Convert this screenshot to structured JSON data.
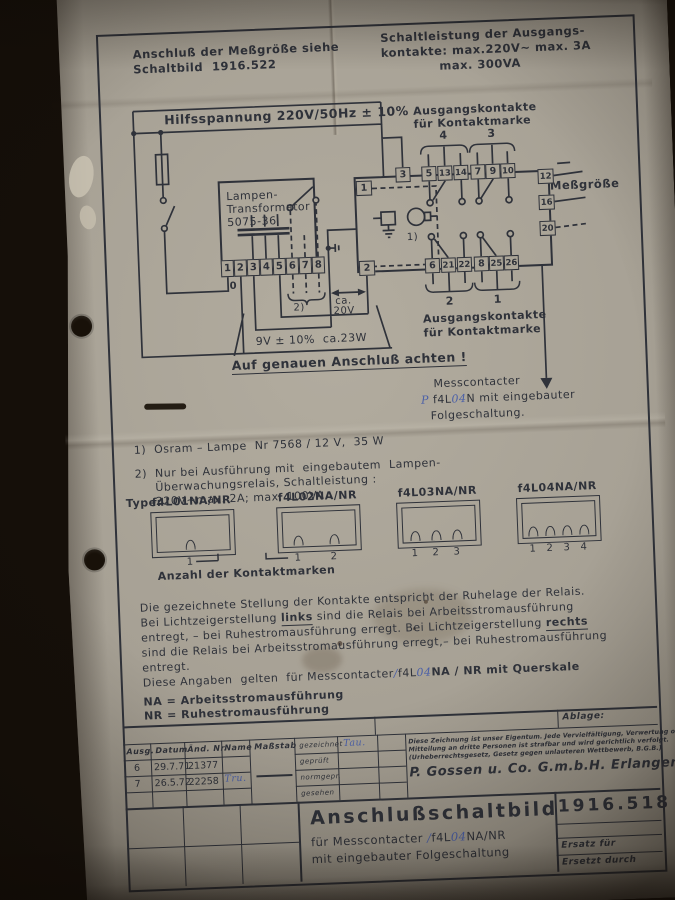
{
  "colors": {
    "paper": "#a9a397",
    "ink": "#2f323a",
    "hand_ink": "#4a5fa8"
  },
  "header": {
    "note_left_1": "Anschluß der Meßgröße siehe",
    "note_left_2": "Schaltbild  1916.522",
    "note_right_1": "Schaltleistung der Ausgangs-",
    "note_right_2": "kontakte: max.220V~ max. 3A",
    "note_right_3": "max. 300VA"
  },
  "schematic": {
    "bus_label": "Hilfsspannung 220V/50Hz ± 10%",
    "out_top": {
      "line1": "Ausgangskontakte",
      "line2": "für Kontaktmarke",
      "n_left": "4",
      "n_right": "3"
    },
    "out_bottom": {
      "n_left": "2",
      "n_right": "1",
      "line1": "Ausgangskontakte",
      "line2": "für Kontaktmarke"
    },
    "trafo": {
      "name1": "Lampen-",
      "name2": "Transformator",
      "name3": "5075-36",
      "terminals": [
        "1",
        "2",
        "3",
        "4",
        "5",
        "6",
        "7",
        "8"
      ],
      "zero": "0"
    },
    "relay": {
      "t1": "1",
      "t2": "2",
      "lamp_note": "1)",
      "top": [
        "3",
        "5",
        "13",
        "14",
        "7",
        "9",
        "10"
      ],
      "bottom": [
        "6",
        "21",
        "22",
        "8",
        "25",
        "26"
      ],
      "right": [
        "12",
        "16",
        "20"
      ]
    },
    "messgroesse": "Meßgröße",
    "note2_mark": "2)",
    "ca20v_1": "ca.",
    "ca20v_2": "20V",
    "volts9": "9V ± 10%  ca.23W",
    "warning": "Auf genauen Anschluß achten !",
    "pointer": {
      "line1": "Messcontacter",
      "hw1": "P ",
      "print1": "f4L",
      "hw2": "04",
      "print2": "N mit eingebauter",
      "line3": "Folgeschaltung."
    }
  },
  "notes": {
    "n1": "1)  Osram – Lampe  Nr 7568 / 12 V,  35 W",
    "n2_1": "2)  Nur bei Ausführung mit  eingebautem  Lampen-",
    "n2_2": "Überwachungsrelais, Schaltleistung :",
    "n2_3": "220V~max. 2A; max. 100VA ."
  },
  "types": {
    "label": "Type:",
    "names": [
      "f4L01NA/NR",
      "f4L02NA/NR",
      "f4L03NA/NR",
      "f4L04NA/NR"
    ],
    "nums1": [
      "1"
    ],
    "nums2": [
      "1",
      "2"
    ],
    "nums3": [
      "1",
      "2",
      "3"
    ],
    "nums4": [
      "1",
      "2",
      "3",
      "4"
    ],
    "anzahl": "Anzahl der Kontaktmarken"
  },
  "paragraph": {
    "l1": "Die gezeichnete Stellung der Kontakte entspricht der Ruhelage der Relais.",
    "l2a": "Bei Lichtzeigerstellung ",
    "l2b": "links",
    "l2c": " sind die Relais bei Arbeitsstromausführung",
    "l3a": "entregt, – bei Ruhestromausführung erregt. Bei Lichtzeigerstellung ",
    "l3b": "rechts",
    "l4": "sind die Relais bei Arbeitsstromausführung erregt,– bei Ruhestromausführung",
    "l5": "entregt.",
    "l6a": "Diese Angaben  gelten  für Messcontacter",
    "l6hw1": "∕",
    "l6b": "f4L",
    "l6hw2": "04",
    "l6c": "NA / NR mit Querskale"
  },
  "legend": {
    "na": "NA = Arbeitsstromausführung",
    "nr": "NR = Ruhestromausführung"
  },
  "titleblock": {
    "ablage": "Ablage:",
    "h_ausg": "Ausg.",
    "h_datum": "Datum",
    "h_aend": "Änd. Nr.",
    "h_name": "Name",
    "h_mass": "Maßstab",
    "r1_ausg": "6",
    "r1_datum": "29.7.71",
    "r1_aend": "21377",
    "r1_name": "",
    "r2_ausg": "7",
    "r2_datum": "26.5.72",
    "r2_aend": "22258",
    "r2_name": "Tru.",
    "sign1": "gezeichnet",
    "sign2": "geprüft",
    "sign3": "normgepr.",
    "sign4": "gesehen",
    "sign1_val": "Tau.",
    "legal_1": "Diese Zeichnung ist unser Eigentum. Jede Vervielfältigung, Verwertung oder",
    "legal_2": "Mitteilung an dritte Personen ist strafbar und wird gerichtlich verfolgt.",
    "legal_3": "(Urheberrechtsgesetz, Gesetz gegen unlauteren Wettbewerb, B.G.B.)",
    "company": "P. Gossen u. Co. G.m.b.H. Erlangen",
    "title": "Anschlußschaltbild",
    "sub1a": "für Messcontacter ",
    "sub1hw1": "∕",
    "sub1b": "f4L",
    "sub1hw2": "04",
    "sub1c": "NA/NR",
    "sub2": "mit eingebauter Folgeschaltung",
    "number": "1916.518",
    "ersatz": "Ersatz für",
    "ersetzt": "Ersetzt durch"
  }
}
